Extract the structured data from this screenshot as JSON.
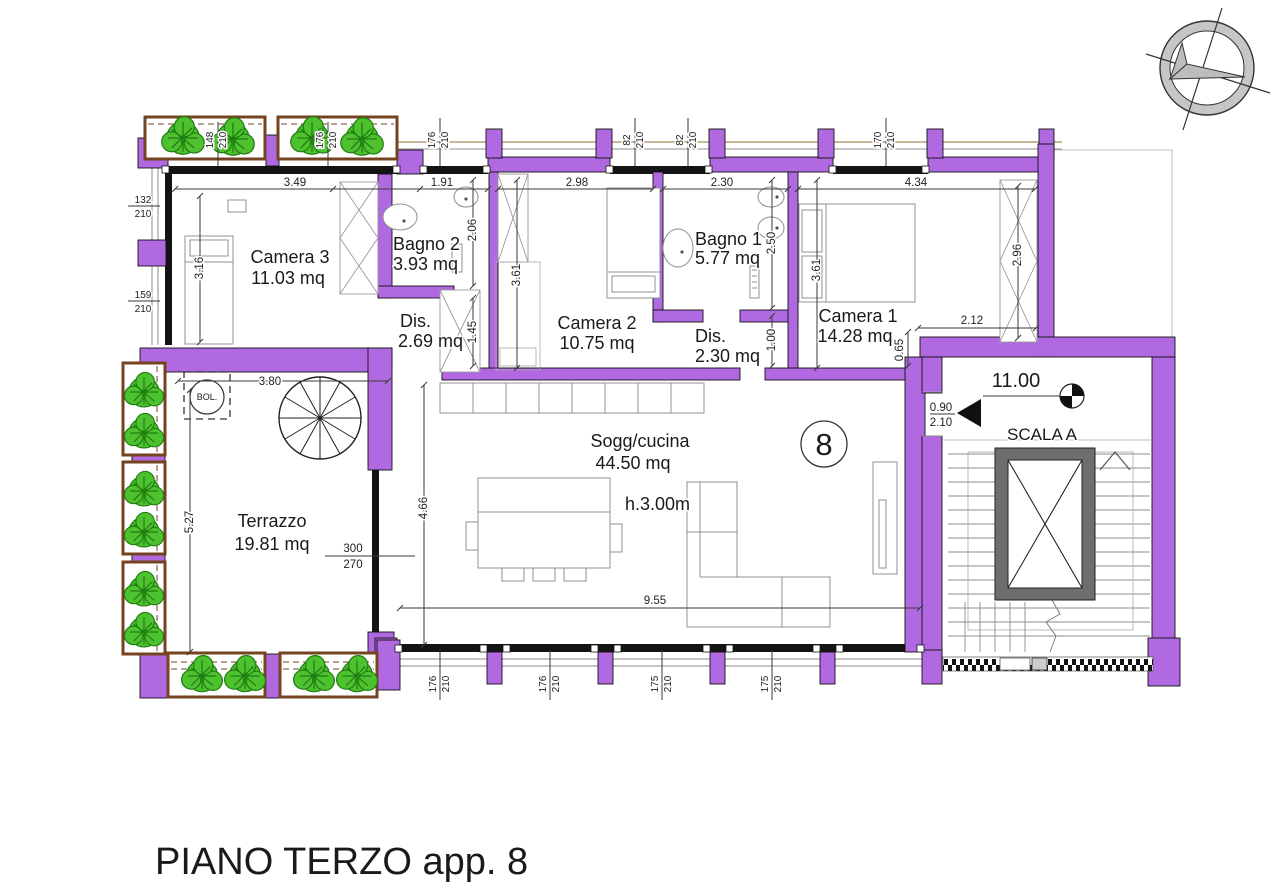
{
  "title": "PIANO TERZO app. 8",
  "rooms": {
    "camera3": {
      "name": "Camera 3",
      "area": "11.03 mq"
    },
    "bagno2": {
      "name": "Bagno 2",
      "area": "3.93 mq"
    },
    "dis1": {
      "name": "Dis.",
      "area": "2.69 mq"
    },
    "camera2": {
      "name": "Camera 2",
      "area": "10.75 mq"
    },
    "bagno1": {
      "name": "Bagno 1",
      "area": "5.77 mq"
    },
    "dis2": {
      "name": "Dis.",
      "area": "2.30 mq"
    },
    "camera1": {
      "name": "Camera 1",
      "area": "14.28 mq"
    },
    "sogg": {
      "name": "Sogg/cucina",
      "area": "44.50 mq",
      "height": "h.3.00m"
    },
    "terrazzo": {
      "name": "Terrazzo",
      "area": "19.81 mq"
    },
    "scala": {
      "name": "SCALA A",
      "level": "11.00"
    }
  },
  "annotations": {
    "apartment_number": "8",
    "boiler": "BOL.",
    "entrance_door": {
      "w": "0.90",
      "h": "2.10"
    },
    "terrace_door": {
      "w": "300",
      "h": "270"
    }
  },
  "dims": {
    "d349": "3.49",
    "d191": "1.91",
    "d298": "2.98",
    "d230": "2.30",
    "d434": "4.34",
    "d316": "3.16",
    "d206": "2.06",
    "d145": "1.45",
    "d361a": "3.61",
    "d361b": "3.61",
    "d250": "2.50",
    "d100": "1.00",
    "d296": "2.96",
    "d212": "2.12",
    "d065": "0.65",
    "d380": "3.80",
    "d527": "5.27",
    "d466": "4.66",
    "d955": "9.55"
  },
  "windows": {
    "top": [
      {
        "w": "148",
        "h": "210"
      },
      {
        "w": "176",
        "h": "210"
      },
      {
        "w": "176",
        "h": "210"
      },
      {
        "w": "82",
        "h": "210"
      },
      {
        "w": "82",
        "h": "210"
      },
      {
        "w": "170",
        "h": "210"
      }
    ],
    "left": [
      {
        "w": "132",
        "h": "210"
      },
      {
        "w": "159",
        "h": "210"
      }
    ],
    "bottom": [
      {
        "w": "176",
        "h": "210"
      },
      {
        "w": "176",
        "h": "210"
      },
      {
        "w": "175",
        "h": "210"
      },
      {
        "w": "175",
        "h": "210"
      }
    ]
  },
  "colors": {
    "wall": "#b169e2",
    "glass": "#141414",
    "plant": "#4ec22e",
    "planter_wood": "#74431f",
    "elevator": "#6e6e6e"
  }
}
